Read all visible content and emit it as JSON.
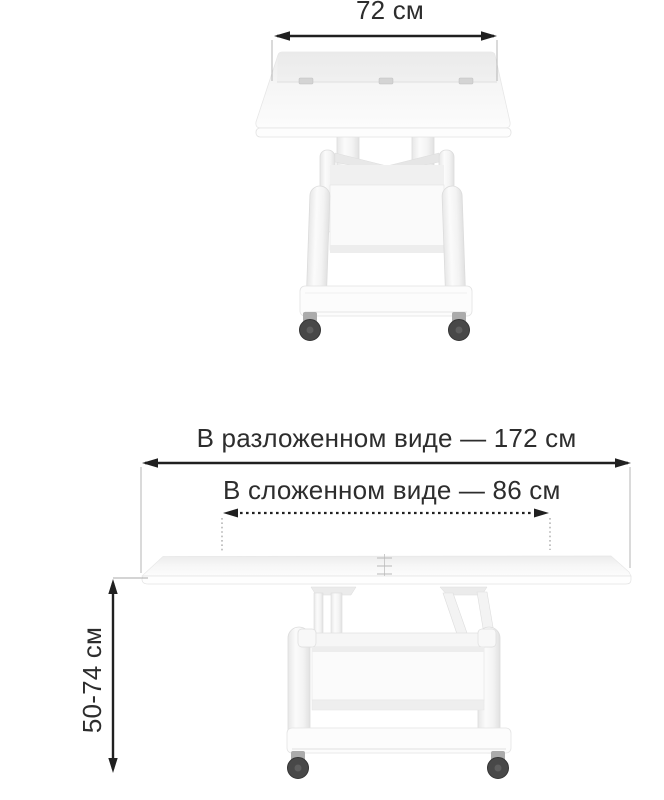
{
  "labels": {
    "top_width": "72 см",
    "unfolded_width": "В разложенном виде — 172 см",
    "folded_width": "В сложенном виде — 86 см",
    "height_range": "50-74 см"
  },
  "colors": {
    "background": "#ffffff",
    "dimension_arrow": "#202020",
    "label_text": "#2d2d2d",
    "extension_line": "#b6b6b6",
    "dotted_extension_line": "#9c9c9c",
    "furniture_outline": "#e4e4e4",
    "furniture_fill": "#fafafa",
    "wheel": "#484848"
  },
  "figures": {
    "top": {
      "view": "front view, tabletop folded (72 cm wide)"
    },
    "bottom": {
      "view": "side view, tabletop unfolded (172 cm wide, height 50-74 cm)"
    }
  }
}
